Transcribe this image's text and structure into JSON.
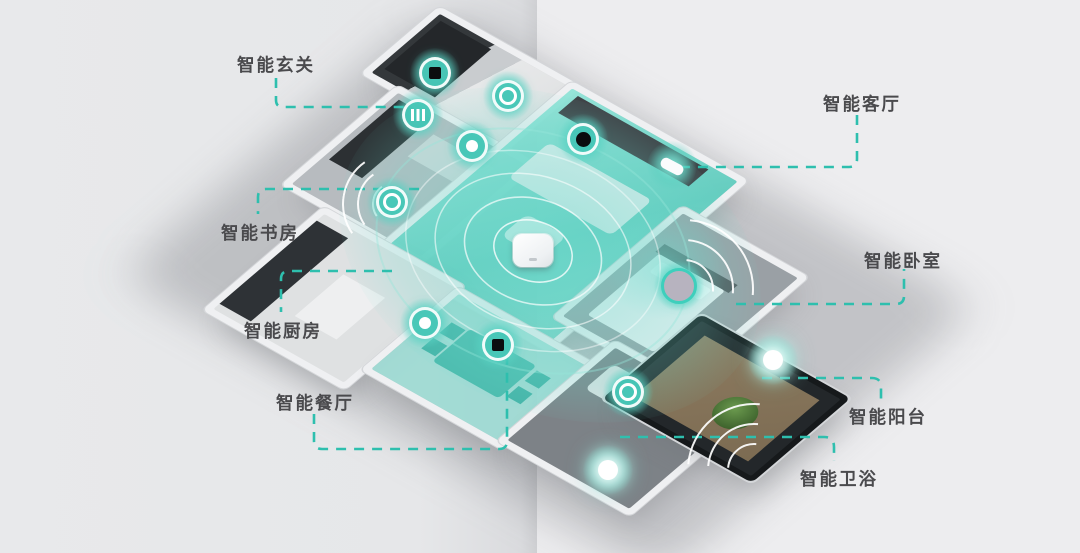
{
  "scene": {
    "description_labels_language": "zh-CN",
    "background_left": "#e6e7e9",
    "background_right": "#ededef",
    "accent_teal": "#2ebfae",
    "label_color": "#4a4a4d",
    "glow_color": "#5fd0c1"
  },
  "labels": {
    "entrance": "智能玄关",
    "living": "智能客厅",
    "study": "智能书房",
    "kitchen": "智能厨房",
    "bedroom": "智能卧室",
    "dining": "智能餐厅",
    "balcony": "智能阳台",
    "bathroom": "智能卫浴"
  },
  "devices": [
    {
      "id": "entrance-door-panel",
      "icon": "screen-panel-icon",
      "room": "entrance"
    },
    {
      "id": "entrance-radiator",
      "icon": "radiator-icon",
      "room": "entrance"
    },
    {
      "id": "entrance-speaker",
      "icon": "ring-speaker-icon",
      "room": "entrance"
    },
    {
      "id": "hallway-sensor",
      "icon": "dot-sensor-icon",
      "room": "entrance"
    },
    {
      "id": "living-camera",
      "icon": "camera-lens-icon",
      "room": "living"
    },
    {
      "id": "living-wall-switch",
      "icon": "wall-switch-icon",
      "room": "living"
    },
    {
      "id": "study-speaker",
      "icon": "ring-speaker-icon",
      "room": "study"
    },
    {
      "id": "kitchen-sensor",
      "icon": "dot-sensor-icon",
      "room": "kitchen"
    },
    {
      "id": "dining-control-panel",
      "icon": "screen-panel-icon",
      "room": "dining"
    },
    {
      "id": "central-hub",
      "icon": "gateway-hub-icon",
      "room": "living"
    },
    {
      "id": "bedroom-sensor",
      "icon": "disc-sensor-icon",
      "room": "bedroom"
    },
    {
      "id": "balcony-light",
      "icon": "glow-light-icon",
      "room": "balcony"
    },
    {
      "id": "bathroom-speaker",
      "icon": "ring-speaker-icon",
      "room": "bathroom"
    },
    {
      "id": "bathroom-light",
      "icon": "glow-light-icon",
      "room": "bathroom"
    }
  ]
}
